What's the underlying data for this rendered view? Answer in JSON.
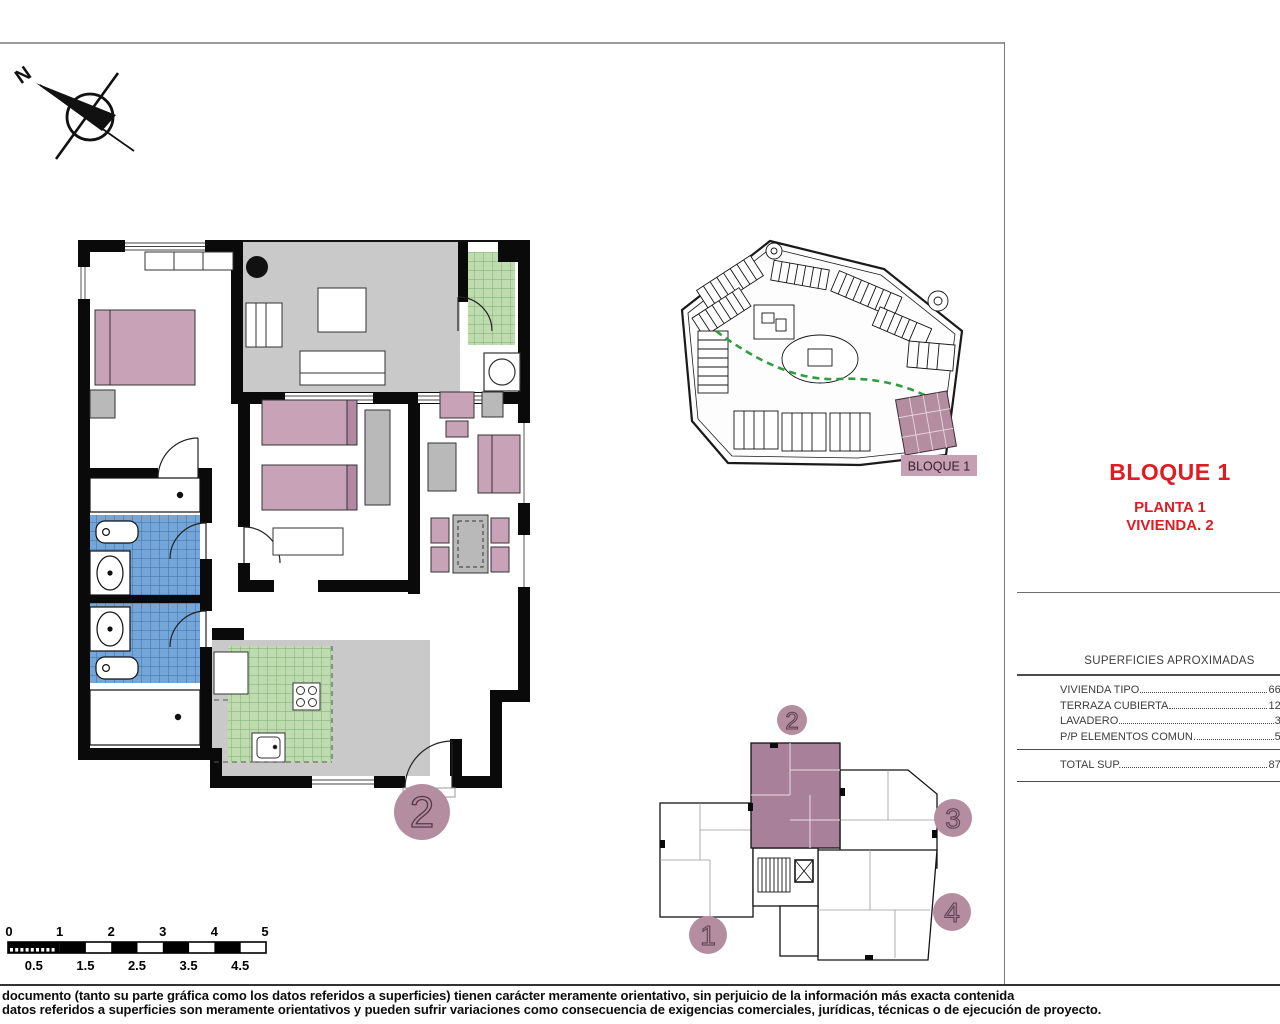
{
  "titles": {
    "bloque": "BLOQUE 1",
    "planta": "PLANTA 1",
    "vivienda": "VIVIENDA. 2"
  },
  "compass": {
    "label": "N"
  },
  "site_plan": {
    "block_label": "BLOQUE 1"
  },
  "floor_plan": {
    "unit_number": "2"
  },
  "key_plan": {
    "unit_numbers": [
      "1",
      "2",
      "3",
      "4"
    ],
    "highlighted_unit": "2"
  },
  "surfaces_table": {
    "title": "SUPERFICIES APROXIMADAS",
    "rows": [
      {
        "label": "VIVIENDA TIPO",
        "value": "66,22"
      },
      {
        "label": "TERRAZA CUBIERTA",
        "value": "12,16"
      },
      {
        "label": "LAVADERO",
        "value": "3,56"
      },
      {
        "label": "P/P ELEMENTOS COMUN.",
        "value": "5,96"
      }
    ],
    "total_row": {
      "label": "TOTAL SUP.",
      "value": "87,86"
    }
  },
  "scale_bar": {
    "top_labels": [
      "0",
      "1",
      "2",
      "3",
      "4",
      "5"
    ],
    "bottom_labels": [
      "0.5",
      "1.5",
      "2.5",
      "3.5",
      "4.5"
    ]
  },
  "footer": {
    "line1": "documento (tanto su parte gráfica como los datos referidos a superficies) tienen carácter meramente orientativo, sin perjuicio de la información más exacta contenida",
    "line2": "datos referidos a superficies son meramente orientativos y pueden sufrir variaciones como consecuencia de exigencias comerciales, jurídicas, técnicas o de ejecución de proyecto."
  },
  "colors": {
    "accent_red": "#e11b22",
    "highlight_mauve": "#b48da1",
    "furniture_pink": "#c8a3b8",
    "tile_green": "#bedcb0",
    "tile_blue": "#74a6da",
    "floor_gray": "#c9c9c9"
  }
}
